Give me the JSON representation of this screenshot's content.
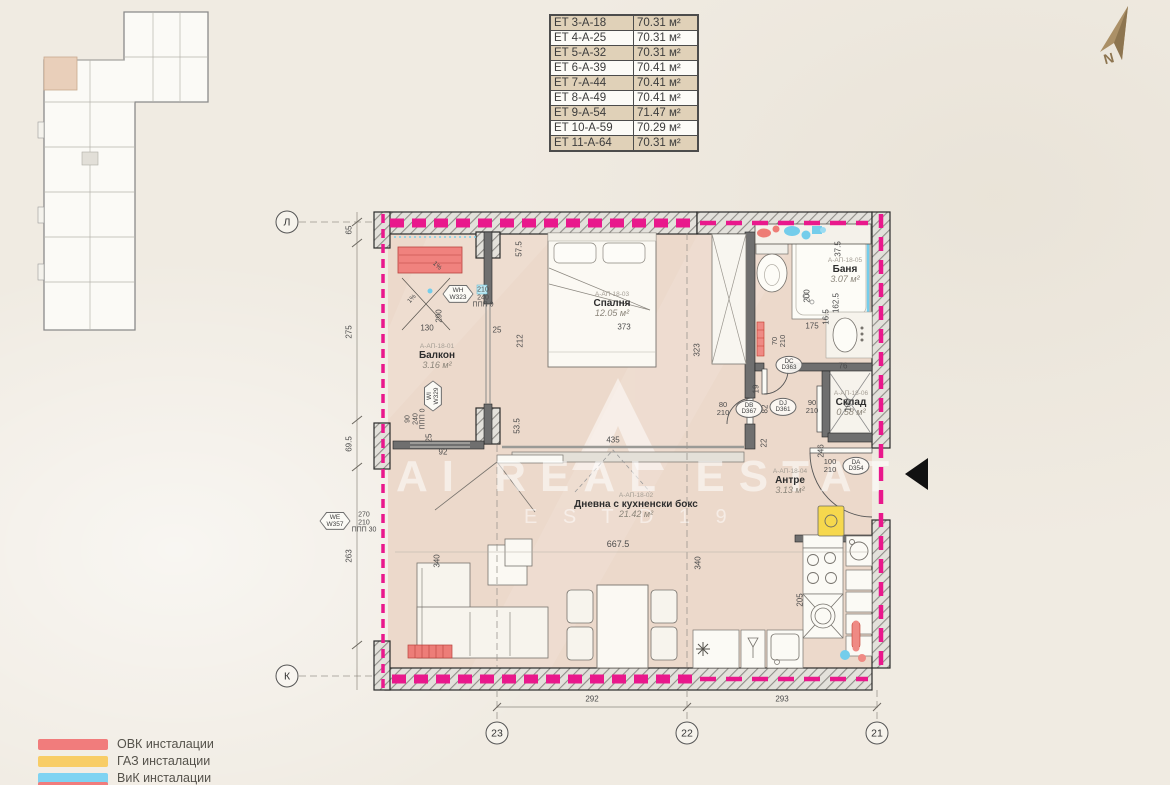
{
  "area_table": {
    "rows": [
      {
        "label": "ET 3-A-18",
        "area": "70.31 м²"
      },
      {
        "label": "ET 4-A-25",
        "area": "70.31 м²"
      },
      {
        "label": "ET 5-A-32",
        "area": "70.31 м²"
      },
      {
        "label": "ET 6-A-39",
        "area": "70.41 м²"
      },
      {
        "label": "ET 7-A-44",
        "area": "70.41 м²"
      },
      {
        "label": "ET 8-A-49",
        "area": "70.41 м²"
      },
      {
        "label": "ET 9-A-54",
        "area": "71.47 м²"
      },
      {
        "label": "ET 10-A-59",
        "area": "70.29 м²"
      },
      {
        "label": "ET 11-A-64",
        "area": "70.31 м²"
      }
    ]
  },
  "north": {
    "label": "N"
  },
  "legend": {
    "items": [
      {
        "label": "ОВК инсталации",
        "color": "#f17c7c"
      },
      {
        "label": "ГАЗ инсталации",
        "color": "#f8cd66"
      },
      {
        "label": "ВиК инсталации",
        "color": "#7fd3f2"
      }
    ]
  },
  "axes": {
    "left": [
      {
        "id": "Л"
      },
      {
        "id": "К"
      }
    ],
    "bottom": [
      {
        "id": "23"
      },
      {
        "id": "22"
      },
      {
        "id": "21"
      }
    ]
  },
  "axis_dims": {
    "left": [
      "65",
      "275",
      "69.5",
      "263"
    ],
    "bottom": [
      "292",
      "293"
    ]
  },
  "rooms": {
    "balcony": {
      "id": "А-АП-18-01",
      "name": "Балкон",
      "area": "3.16 м²"
    },
    "living": {
      "id": "А-АП-18-02",
      "name": "Дневна с кухненски бокс",
      "area": "21.42 м²"
    },
    "bedroom": {
      "id": "А-АП-18-03",
      "name": "Спалня",
      "area": "12.05 м²"
    },
    "antre": {
      "id": "А-АП-18-04",
      "name": "Антре",
      "area": "3.13 м²"
    },
    "bath": {
      "id": "А-АП-18-05",
      "name": "Баня",
      "area": "3.07 м²"
    },
    "storage": {
      "id": "А-АП-18-06",
      "name": "Склад",
      "area": "0.58 м²"
    }
  },
  "windows": {
    "wh": {
      "code": "WH",
      "num": "W323",
      "w": "210",
      "h": "240",
      "note": "ППП 0"
    },
    "wi": {
      "code": "WI",
      "num": "W329",
      "w": "90",
      "h": "240",
      "note": "ППП 0"
    },
    "we": {
      "code": "WE",
      "num": "W357",
      "w": "270",
      "h": "210",
      "note": "ППП 30"
    }
  },
  "doors": {
    "da": {
      "code": "DA",
      "num": "D354",
      "w": "100",
      "h": "210"
    },
    "db": {
      "code": "DB",
      "num": "D367",
      "w": "80",
      "h": "210"
    },
    "dc": {
      "code": "DC",
      "num": "D363",
      "w": "70",
      "h": "210"
    },
    "dj": {
      "code": "DJ",
      "num": "D361",
      "w": "90",
      "h": "210"
    }
  },
  "dims": {
    "balc_h": "290",
    "balc_w": "130",
    "balc_gap": "25",
    "bed_off": "212",
    "niche": "57.5",
    "mid": "53.5",
    "bed_w": "373",
    "bed_h": "323",
    "slide": "435",
    "liv_w": "667.5",
    "liv_h": "340",
    "sofa_h": "340",
    "l92": "92",
    "l25": "25",
    "bath_h": "200",
    "bath_w": "175",
    "bath_h2": "162.5",
    "bath_t": "37.5",
    "st_w": "76",
    "st_off": "16.5",
    "st_h": "100",
    "hall_h": "246",
    "h22": "22",
    "h19": "19",
    "h82": "82",
    "k205": "205",
    "slope": "1%"
  },
  "watermark": {
    "line1": "AI REAL ESTAT",
    "line2": "E S T D 1 9"
  }
}
